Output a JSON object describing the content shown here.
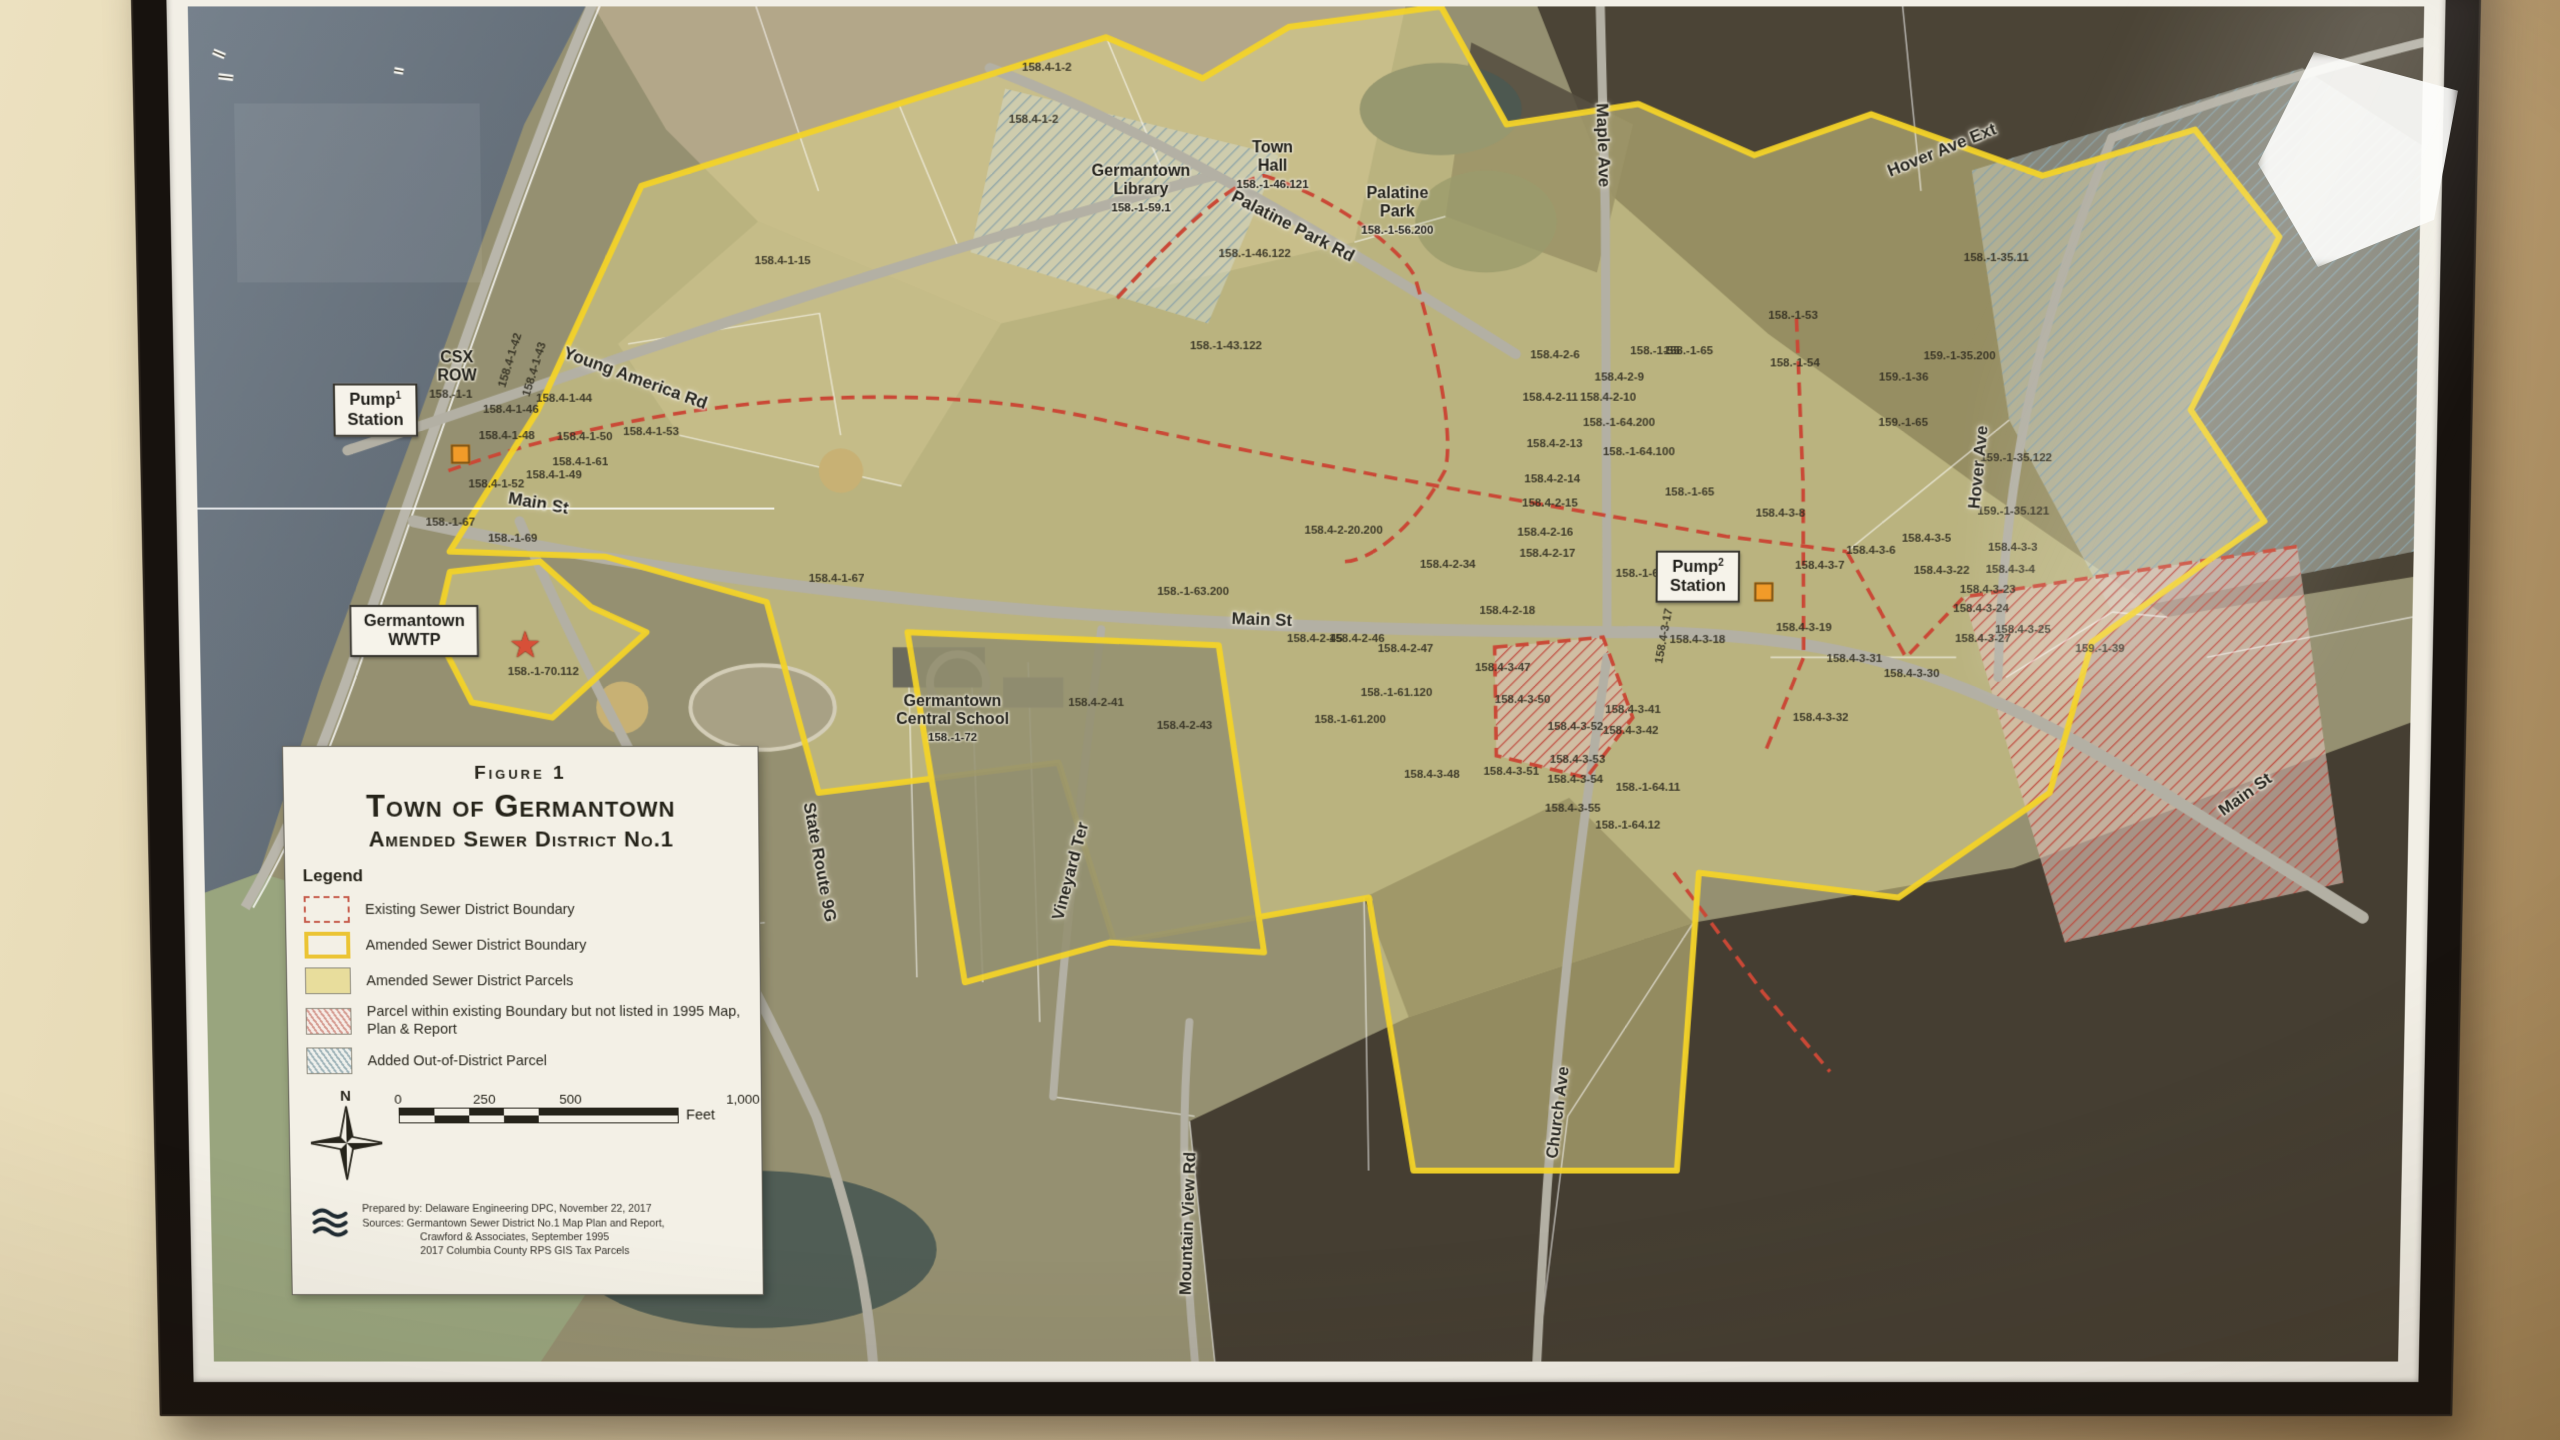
{
  "scene": {
    "description": "Framed aerial-photo map hanging on a beige wall",
    "wall_color": "#d9c69d",
    "frame_color": "#17120e",
    "mat_color": "#f2efe6",
    "boundary_yellow": "#f5d320",
    "existing_red": "#cc4a38",
    "district_parcel_fill": "#e9dd99",
    "water_color": "#66707c",
    "pump_marker_color": "#f59a23",
    "wwtp_star_color": "#dd4f35"
  },
  "title_box": {
    "figure": "Figure 1",
    "title": "Town of Germantown",
    "subtitle": "Amended Sewer District No.1"
  },
  "legend": {
    "heading": "Legend",
    "items": [
      {
        "swatch": "existing-boundary",
        "label": "Existing Sewer District Boundary"
      },
      {
        "swatch": "amended-boundary",
        "label": "Amended Sewer District Boundary"
      },
      {
        "swatch": "amended-parcels",
        "label": "Amended Sewer District Parcels"
      },
      {
        "swatch": "parcel-not-listed",
        "label": "Parcel within existing Boundary but not listed in 1995 Map, Plan & Report"
      },
      {
        "swatch": "out-of-district",
        "label": "Added Out-of-District Parcel"
      }
    ],
    "north_label": "N",
    "scale_bar": {
      "ticks": [
        "0",
        "250",
        "500",
        "1,000"
      ],
      "unit": "Feet"
    },
    "credits": [
      "Prepared by: Delaware Engineering DPC, November 22, 2017",
      "Sources: Germantown Sewer District No.1 Map Plan and Report,",
      "Crawford & Associates, September 1995",
      "2017 Columbia County RPS GIS Tax Parcels"
    ]
  },
  "map": {
    "streets": [
      {
        "name": "Young America Rd",
        "x": 19.8,
        "y": 27.0,
        "rot": 20
      },
      {
        "name": "Palatine Park Rd",
        "x": 49.4,
        "y": 15.9,
        "rot": 27
      },
      {
        "name": "Main St",
        "x": 15.4,
        "y": 36.1,
        "rot": 10
      },
      {
        "name": "Main St",
        "x": 48.0,
        "y": 44.7,
        "rot": 2
      },
      {
        "name": "Main St",
        "x": 92.6,
        "y": 57.6,
        "rot": -36
      },
      {
        "name": "State Route 9G",
        "x": 27.9,
        "y": 62.6,
        "rot": 80
      },
      {
        "name": "Vineyard Ter",
        "x": 39.3,
        "y": 63.3,
        "rot": -75
      },
      {
        "name": "Mountain View Rd",
        "x": 44.6,
        "y": 89.6,
        "rot": -88
      },
      {
        "name": "Church Ave",
        "x": 61.5,
        "y": 81.3,
        "rot": -83
      },
      {
        "name": "Maple Ave",
        "x": 63.3,
        "y": 10.0,
        "rot": 88
      },
      {
        "name": "Hover Ave",
        "x": 80.3,
        "y": 33.5,
        "rot": -85
      },
      {
        "name": "Hover Ave Ext",
        "x": 78.5,
        "y": 10.4,
        "rot": -22
      }
    ],
    "boxed_labels": [
      {
        "lines": [
          "Pump",
          "Station"
        ],
        "sup": "1",
        "x": 8.1,
        "y": 29.3,
        "lx": 11.9,
        "ly": 32.5
      },
      {
        "lines": [
          "Pump",
          "Station"
        ],
        "sup": "2",
        "x": 67.7,
        "y": 41.5,
        "lx": 70.7,
        "ly": 42.6
      },
      {
        "lines": [
          "Germantown",
          "WWTP"
        ],
        "sup": "",
        "x": 9.7,
        "y": 45.5,
        "lx": 14.5,
        "ly": 46.6
      }
    ],
    "place_labels": [
      {
        "lines": [
          "Town",
          "Hall"
        ],
        "parcel": "158.-1-46.121",
        "x": 48.5,
        "y": 11.5
      },
      {
        "lines": [
          "Palatine",
          "Park"
        ],
        "parcel": "158.-1-56.200",
        "x": 54.1,
        "y": 14.8
      },
      {
        "lines": [
          "Germantown",
          "Library"
        ],
        "parcel": "158.-1-59.1",
        "x": 42.6,
        "y": 13.2
      },
      {
        "lines": [
          "Germantown",
          "Central School"
        ],
        "parcel": "158.-1-72",
        "x": 34.0,
        "y": 52.0
      },
      {
        "lines": [
          "CSX",
          "ROW"
        ],
        "parcel": "",
        "x": 11.8,
        "y": 26.2
      }
    ],
    "markers": [
      {
        "kind": "pump-station",
        "x": 11.9,
        "y": 32.5
      },
      {
        "kind": "pump-station",
        "x": 70.7,
        "y": 42.6
      },
      {
        "kind": "wwtp-star",
        "x": 14.7,
        "y": 46.6
      }
    ],
    "parcels": [
      {
        "id": "158.-1-1",
        "x": 11.5,
        "y": 28.2
      },
      {
        "id": "158.4-1-42",
        "x": 14.2,
        "y": 25.7,
        "r": -72
      },
      {
        "id": "158.4-1-43",
        "x": 15.3,
        "y": 26.3,
        "r": -72
      },
      {
        "id": "158.4-1-44",
        "x": 16.6,
        "y": 28.5
      },
      {
        "id": "158.4-1-46",
        "x": 14.2,
        "y": 29.3
      },
      {
        "id": "158.4-1-48",
        "x": 14.0,
        "y": 31.2
      },
      {
        "id": "158.4-1-50",
        "x": 17.5,
        "y": 31.3
      },
      {
        "id": "158.4-1-61",
        "x": 17.3,
        "y": 33.1
      },
      {
        "id": "158.4-1-49",
        "x": 16.1,
        "y": 34.1
      },
      {
        "id": "158.4-1-52",
        "x": 13.5,
        "y": 34.7
      },
      {
        "id": "158.4-1-53",
        "x": 20.5,
        "y": 30.9
      },
      {
        "id": "158.-1-67",
        "x": 11.4,
        "y": 37.5
      },
      {
        "id": "158.-1-69",
        "x": 14.2,
        "y": 38.7
      },
      {
        "id": "158.-1-70.112",
        "x": 15.5,
        "y": 48.5
      },
      {
        "id": "158.4-1-2",
        "x": 38.4,
        "y": 4.4
      },
      {
        "id": "158.4-1-2",
        "x": 37.8,
        "y": 8.2
      },
      {
        "id": "158.4-1-15",
        "x": 26.5,
        "y": 18.4
      },
      {
        "id": "158.-1-46.122",
        "x": 47.7,
        "y": 17.9
      },
      {
        "id": "158.-1-43.122",
        "x": 46.4,
        "y": 24.6
      },
      {
        "id": "158.4-1-67",
        "x": 28.8,
        "y": 41.7
      },
      {
        "id": "158.-1-63.200",
        "x": 44.9,
        "y": 42.6
      },
      {
        "id": "158.4-2-41",
        "x": 40.5,
        "y": 50.8
      },
      {
        "id": "158.4-2-43",
        "x": 44.5,
        "y": 52.5
      },
      {
        "id": "158.4-2-20.200",
        "x": 51.7,
        "y": 38.1
      },
      {
        "id": "158.4-2-34",
        "x": 56.4,
        "y": 40.6
      },
      {
        "id": "158.4-2-16",
        "x": 60.8,
        "y": 38.3
      },
      {
        "id": "158.4-2-17",
        "x": 60.9,
        "y": 39.8
      },
      {
        "id": "158.4-2-18",
        "x": 59.1,
        "y": 44.0
      },
      {
        "id": "158.4-2-45",
        "x": 50.4,
        "y": 46.1
      },
      {
        "id": "158.4-2-46",
        "x": 52.3,
        "y": 46.1
      },
      {
        "id": "158.4-2-47",
        "x": 54.5,
        "y": 46.8
      },
      {
        "id": "158.-1-61.120",
        "x": 54.1,
        "y": 50.1
      },
      {
        "id": "158.-1-61.200",
        "x": 52.0,
        "y": 52.1
      },
      {
        "id": "158.4-3-48",
        "x": 55.7,
        "y": 56.1
      },
      {
        "id": "158.4-3-51",
        "x": 59.3,
        "y": 55.9
      },
      {
        "id": "158.4-3-50",
        "x": 59.8,
        "y": 50.6
      },
      {
        "id": "158.4-3-47",
        "x": 58.9,
        "y": 48.2
      },
      {
        "id": "158.4-3-52",
        "x": 62.2,
        "y": 52.6
      },
      {
        "id": "158.4-3-53",
        "x": 62.3,
        "y": 55.0
      },
      {
        "id": "158.4-3-54",
        "x": 62.2,
        "y": 56.5
      },
      {
        "id": "158.4-3-55",
        "x": 62.1,
        "y": 58.6
      },
      {
        "id": "158.-1-64.11",
        "x": 65.5,
        "y": 57.1
      },
      {
        "id": "158.-1-64.12",
        "x": 64.6,
        "y": 59.9
      },
      {
        "id": "158.4-2-6",
        "x": 61.2,
        "y": 25.3
      },
      {
        "id": "158.4-2-9",
        "x": 64.1,
        "y": 26.9
      },
      {
        "id": "158.4-2-10",
        "x": 63.6,
        "y": 28.4
      },
      {
        "id": "158.4-2-11",
        "x": 61.0,
        "y": 28.4
      },
      {
        "id": "158.4-2-13",
        "x": 61.2,
        "y": 31.8
      },
      {
        "id": "158.4-2-14",
        "x": 61.1,
        "y": 34.4
      },
      {
        "id": "158.4-2-15",
        "x": 61.0,
        "y": 36.1
      },
      {
        "id": "158.-1-64.200",
        "x": 64.1,
        "y": 30.2
      },
      {
        "id": "158.-1-64.100",
        "x": 65.0,
        "y": 32.4
      },
      {
        "id": "158.-1-65",
        "x": 67.2,
        "y": 25.0
      },
      {
        "id": "158.-1-65",
        "x": 67.3,
        "y": 35.3
      },
      {
        "id": "158.-1-66",
        "x": 65.1,
        "y": 41.3
      },
      {
        "id": "158.4-3-8",
        "x": 71.4,
        "y": 36.9
      },
      {
        "id": "158.4-3-5",
        "x": 78.0,
        "y": 38.7
      },
      {
        "id": "158.4-3-6",
        "x": 75.5,
        "y": 39.6
      },
      {
        "id": "158.4-3-7",
        "x": 73.2,
        "y": 40.7
      },
      {
        "id": "158.4-3-22",
        "x": 78.7,
        "y": 41.1
      },
      {
        "id": "158.4-3-23",
        "x": 80.8,
        "y": 42.5
      },
      {
        "id": "158.4-3-24",
        "x": 80.5,
        "y": 43.9
      },
      {
        "id": "158.4-3-19",
        "x": 72.5,
        "y": 45.3
      },
      {
        "id": "158.4-3-18",
        "x": 67.7,
        "y": 46.2
      },
      {
        "id": "158.4-3-17",
        "x": 66.2,
        "y": 45.9,
        "r": -80
      },
      {
        "id": "158.4-3-31",
        "x": 74.8,
        "y": 47.6
      },
      {
        "id": "158.4-3-30",
        "x": 77.4,
        "y": 48.7
      },
      {
        "id": "158.4-3-27",
        "x": 80.6,
        "y": 46.1
      },
      {
        "id": "158.4-3-32",
        "x": 73.3,
        "y": 51.9
      },
      {
        "id": "158.4-3-41",
        "x": 64.8,
        "y": 51.3
      },
      {
        "id": "158.4-3-42",
        "x": 64.7,
        "y": 52.9
      },
      {
        "id": "159.-1-35.200",
        "x": 79.4,
        "y": 25.4
      },
      {
        "id": "159.-1-36",
        "x": 76.9,
        "y": 26.9
      },
      {
        "id": "159.-1-65",
        "x": 76.9,
        "y": 30.2
      },
      {
        "id": "158.-1-53",
        "x": 71.9,
        "y": 22.4
      },
      {
        "id": "158.-1-55",
        "x": 65.7,
        "y": 25.0
      },
      {
        "id": "158.-1-54",
        "x": 72.0,
        "y": 25.9
      },
      {
        "id": "158.-1-35.11",
        "x": 81.0,
        "y": 18.2
      },
      {
        "id": "159.-1-35.122",
        "x": 82.0,
        "y": 32.8
      },
      {
        "id": "159.-1-35.121",
        "x": 81.9,
        "y": 36.7
      },
      {
        "id": "158.4-3-3",
        "x": 81.9,
        "y": 39.4
      },
      {
        "id": "158.4-3-4",
        "x": 81.8,
        "y": 41.0
      },
      {
        "id": "158.4-3-25",
        "x": 82.4,
        "y": 45.4
      },
      {
        "id": "159.-1-39",
        "x": 85.9,
        "y": 46.8
      }
    ]
  }
}
